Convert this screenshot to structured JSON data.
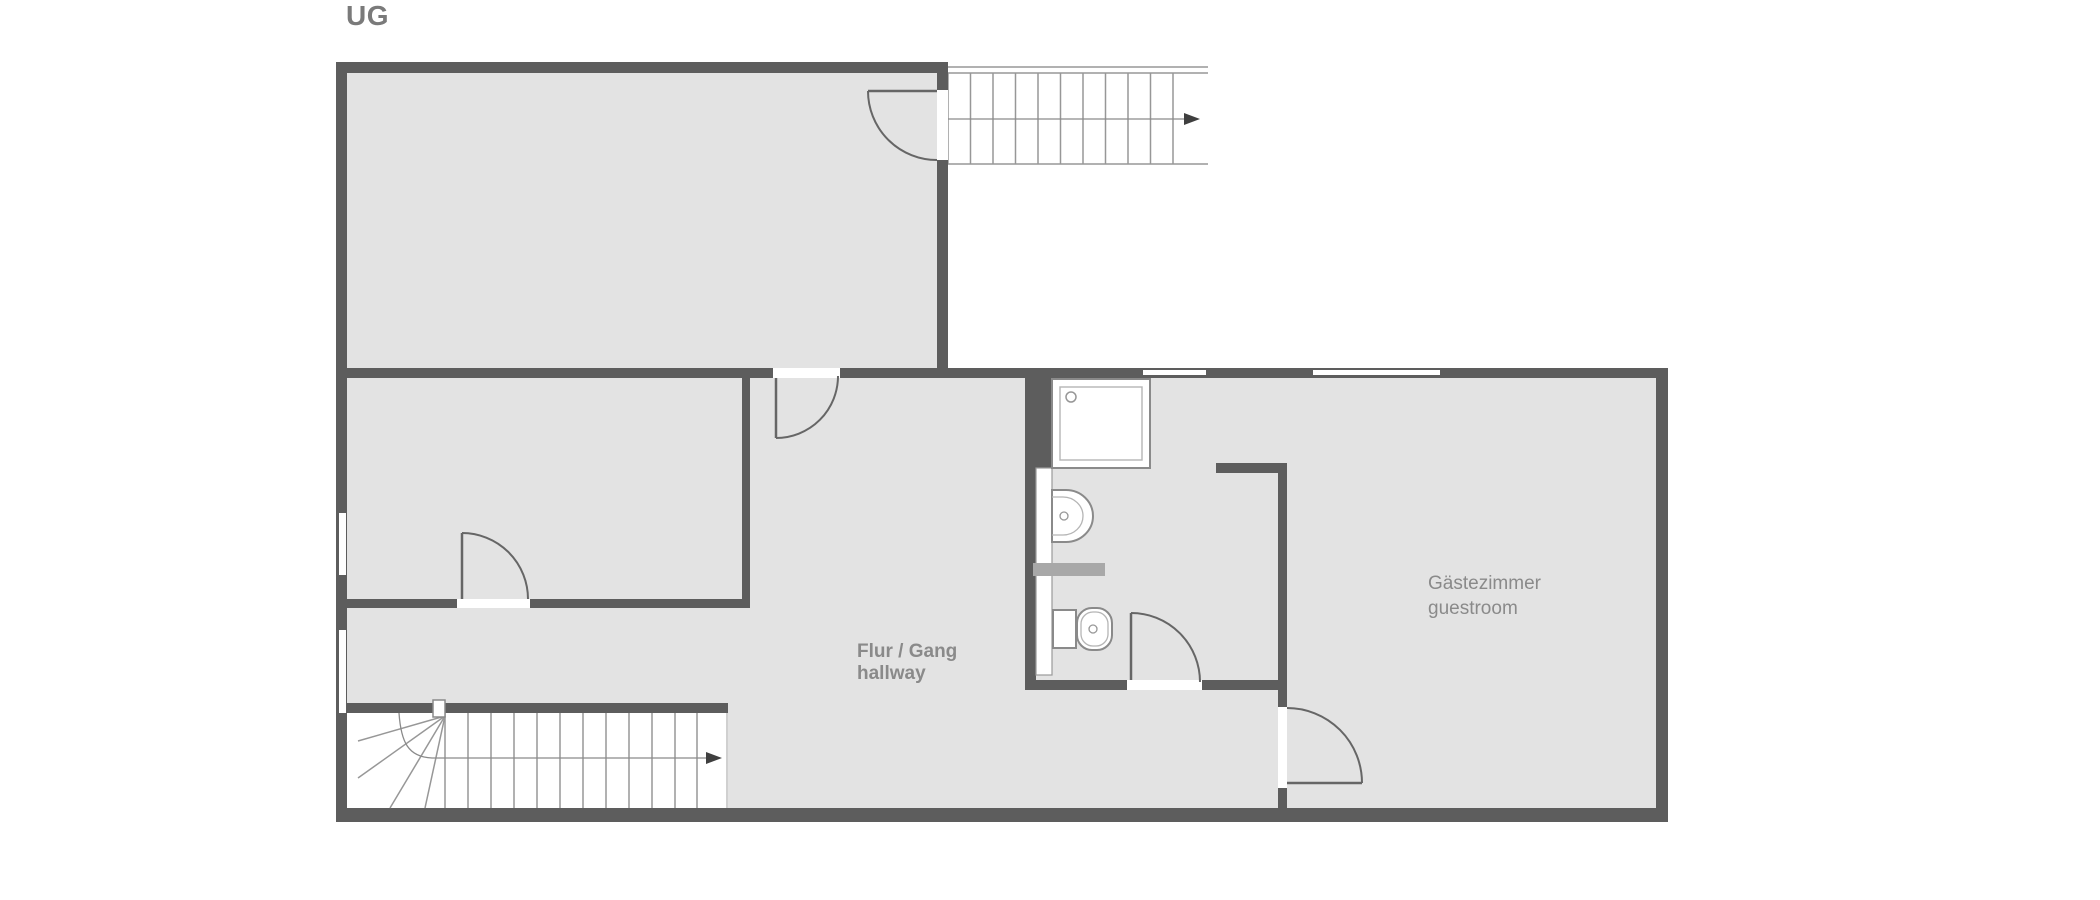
{
  "floor_label": "UG",
  "rooms": {
    "hallway": {
      "name_de": "Flur / Gang",
      "name_en": "hallway"
    },
    "guestroom": {
      "name_de": "Gästezimmer",
      "name_en": "guestroom"
    }
  },
  "stairs": {
    "upper": {
      "direction": "right"
    },
    "lower": {
      "direction": "right"
    }
  },
  "fixtures": [
    "shower",
    "washbasin",
    "toilet"
  ],
  "colors": {
    "background": "#ffffff",
    "wall": "#5d5d5d",
    "floor_fill": "#e3e3e3",
    "stair_line": "#979797",
    "fixture_outline": "#8a8a8a",
    "fixture_inner_line": "#b5b5b5",
    "shelf": "#a8a8a8",
    "door_line": "#666666",
    "arrow": "#3f3f3f",
    "label_text": "#8a8a8a",
    "floor_label_text": "#7a7a7a"
  }
}
